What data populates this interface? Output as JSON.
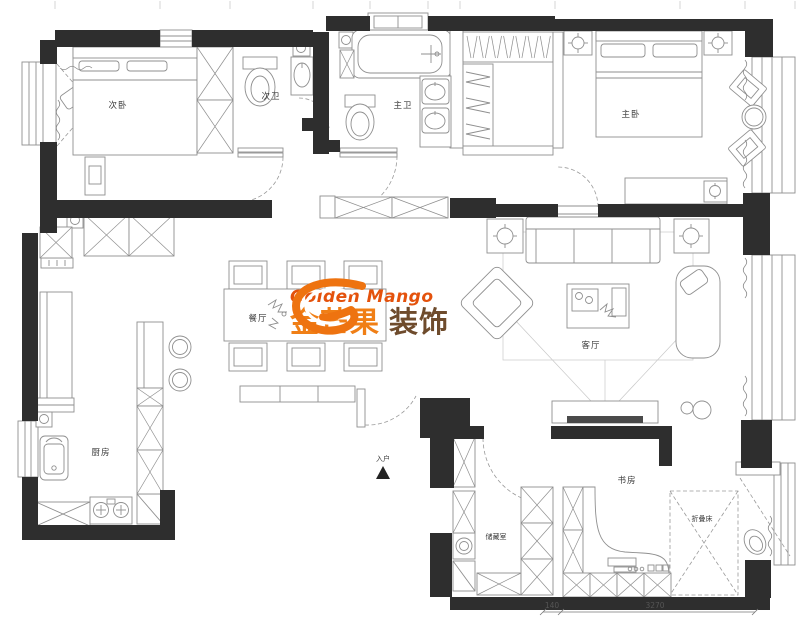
{
  "palette": {
    "wall": "#2e2e2e",
    "line": "#8f8f8f",
    "line_light": "#c9c9c9",
    "text": "#3a3a3a",
    "tv": "#4a4a4a"
  },
  "logo": {
    "brand_en": "Golden Mango",
    "brand_cn": "金芒果",
    "brand_suffix": "装饰",
    "color_en": "#E4520C",
    "color_cn": "#F07F16",
    "color_suffix": "#6E4B2C",
    "mark_color": "#EE7310"
  },
  "rooms": {
    "bedroom2": "次卧",
    "bath2": "次卫",
    "master_bath": "主卫",
    "master_bedroom": "主卧",
    "dining": "餐厅",
    "living": "客厅",
    "kitchen": "厨房",
    "entry": "入户",
    "storage": "储藏室",
    "study": "书房",
    "folding_bed": "折叠床"
  },
  "dimensions": {
    "seg1": "140",
    "seg2": "3270"
  }
}
